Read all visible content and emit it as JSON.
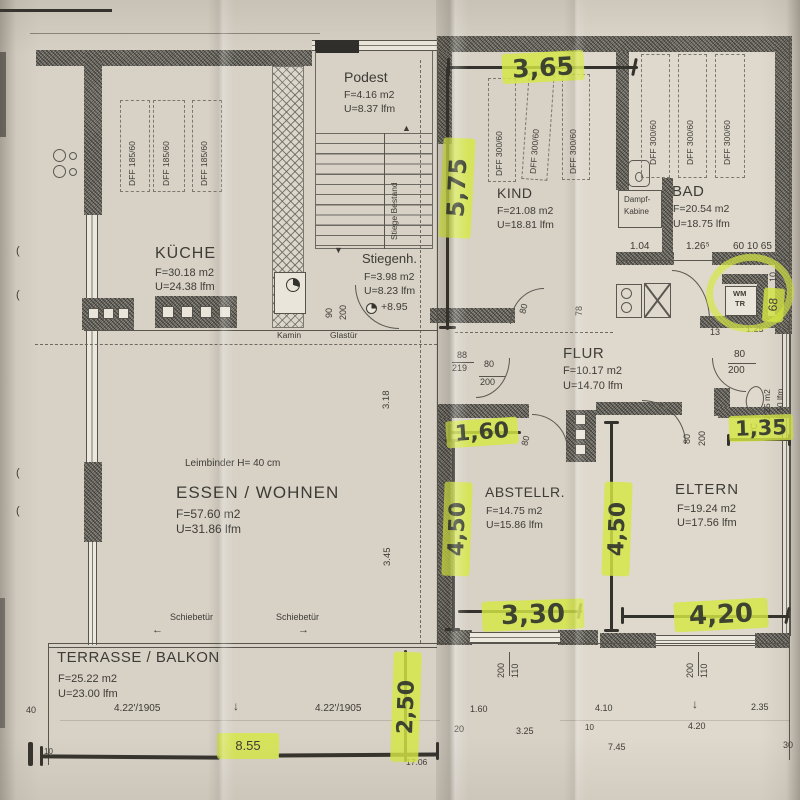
{
  "colors": {
    "paper": "#d7d1c6",
    "ink": "#3e3c36",
    "highlighter": "#d5e844",
    "wall": "#8d8b82"
  },
  "texts": {
    "kueche_name": "KÜCHE",
    "kueche_area": "F=30.18 m2",
    "kueche_perim": "U=24.38 lfm",
    "dff185": "DFF 185/60",
    "dff300": "DFF 300/60",
    "podest_name": "Podest",
    "podest_area": "F=4.16 m2",
    "podest_perim": "U=8.37 lfm",
    "stiege_bestand": "Stiege Bestand",
    "stiegenh_name": "Stiegenh.",
    "stiegenh_area": "F=3.98 m2",
    "stiegenh_perim": "U=8.23 lfm",
    "stiegenh_level": "+8.95",
    "dim_90": "90",
    "dim_200_door": "200",
    "kamin": "Kamin",
    "glastuer": "Glastür",
    "kind_name": "KIND",
    "kind_area": "F=21.08 m2",
    "kind_perim": "U=18.81 lfm",
    "bad_name": "BAD",
    "bad_area": "F=20.54 m2",
    "bad_perim": "U=18.75 lfm",
    "dampf1": "Dampf-",
    "dampf2": "Kabine",
    "dim_104": "1.04",
    "dim_1265": "1.26⁵",
    "dim_60_10_65": "60  10  65",
    "wm": "WM",
    "tr": "TR",
    "dim_10_niche": "10",
    "dim_13": "13",
    "dim_125": "1.25",
    "dim_80_wc": "80",
    "dim_200_wc": "200",
    "wc_name": "WC",
    "wc_area": "F=2.25 m2",
    "wc_perim": "U=6.10 lfm",
    "flur_name": "FLUR",
    "flur_area": "F=10.17 m2",
    "flur_perim": "U=14.70 lfm",
    "dim_78": "78",
    "dim_88": "88",
    "dim_219": "219",
    "dim_80_flur": "80",
    "dim_200_flur": "200",
    "dim_80_kind": "80",
    "dim_80_eltern": "80",
    "dim_200_eltern": "200",
    "dim_80_abst": "80",
    "eltern_name": "ELTERN",
    "eltern_area": "F=19.24 m2",
    "eltern_perim": "U=17.56 lfm",
    "abstell_name": "ABSTELLR.",
    "abstell_area": "F=14.75 m2",
    "abstell_perim": "U=15.86 lfm",
    "essen_leimbinder": "Leimbinder H= 40 cm",
    "essen_name": "ESSEN / WOHNEN",
    "essen_area": "F=57.60 m2",
    "essen_perim": "U=31.86 lfm",
    "dim_318": "3.18",
    "dim_345": "3.45",
    "schiebetuer": "Schiebetür",
    "terrasse_name": "TERRASSE / BALKON",
    "terrasse_area": "F=25.22 m2",
    "terrasse_perim": "U=23.00 lfm",
    "dim_422": "4.22'/1905",
    "dim_40": "40",
    "dim_10_bl": "10",
    "dim_855": "8.55",
    "dim_160b": "1.60",
    "dim_20": "20",
    "dim_325": "3.25",
    "dim_1706": "17.06",
    "dim_410": "4.10",
    "dim_10_br": "10",
    "dim_745": "7.45",
    "dim_420b": "4.20",
    "dim_235": "2.35",
    "dim_30": "30",
    "dim_200_abw": "200",
    "dim_110_abw": "110",
    "dim_200_elw": "200",
    "dim_110_elw": "110"
  },
  "highlights": {
    "h365": "3,65",
    "h575": "5,75",
    "h160": "1,60",
    "h450a": "4,50",
    "h330": "3,30",
    "h450b": "4,50",
    "h420": "4,20",
    "h135": "1,35",
    "h250": "2,50",
    "h68": "68"
  },
  "icons": {
    "arrow_left": "←",
    "arrow_right": "→",
    "arrow_down": "↓",
    "stair_up": "▲",
    "stair_down": "▼",
    "window_mark": "("
  }
}
